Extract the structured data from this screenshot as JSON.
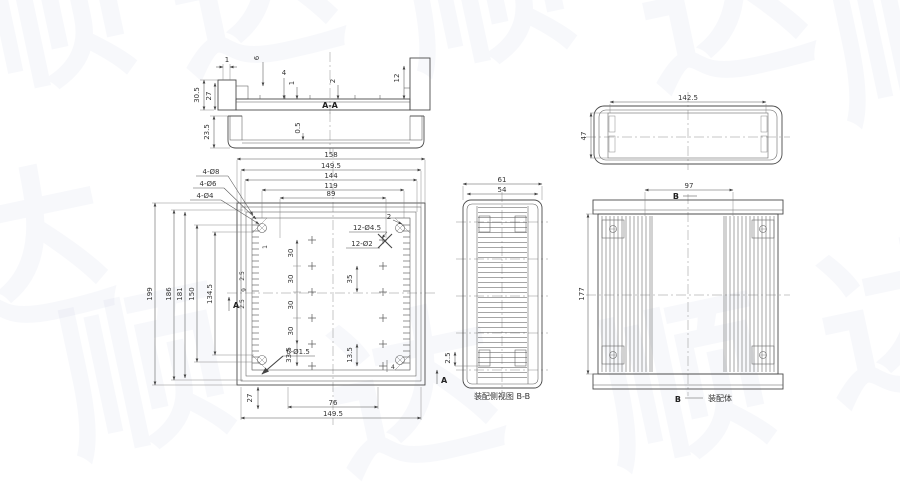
{
  "watermark": {
    "glyphs": [
      "顺",
      "达",
      "顺",
      "达",
      "顺",
      "达",
      "顺",
      "达",
      "顺",
      "达"
    ]
  },
  "section_aa": {
    "label": "A-A",
    "dims": {
      "total_h": "30.5",
      "inner_h": "27",
      "lip": "1",
      "step": "6",
      "web_a": "4",
      "web_b": "1",
      "web_c": "2",
      "right_depth": "12"
    }
  },
  "lid_section": {
    "dims": {
      "height": "23.5",
      "web": "0.5"
    }
  },
  "front_view": {
    "top_dims": [
      "158",
      "149.5",
      "144",
      "119",
      "89"
    ],
    "left_dims": [
      "199",
      "186",
      "181",
      "150",
      "134.5"
    ],
    "bottom_dims": [
      "76",
      "149.5"
    ],
    "corner_hole_labels": [
      "4-Ø8",
      "4-Ø6",
      "4-Ø4"
    ],
    "grid_hole_labels": [
      "12-Ø4.5",
      "12-Ø2"
    ],
    "bottom_hole_label": "6-Ø1.5",
    "pitch_dims": [
      "30",
      "30",
      "30",
      "30"
    ],
    "dims": {
      "d335": "33.5",
      "d35": "35",
      "d135": "13.5",
      "d2": "2",
      "d25a": "2.5",
      "d9": "9",
      "d25b": "2.5",
      "d1": "1",
      "d4": "4",
      "d27": "27"
    },
    "section_marker": "A"
  },
  "side_view": {
    "dims": {
      "outer_w": "61",
      "inner_w": "54",
      "d25": "2.5"
    },
    "caption": "装配侧视图 B-B"
  },
  "cover_view": {
    "dims": {
      "width": "142.5",
      "height": "47"
    }
  },
  "assembly_view": {
    "dims": {
      "inner_w": "97",
      "height": "177"
    },
    "section_marker": "B",
    "caption": "装配体"
  }
}
